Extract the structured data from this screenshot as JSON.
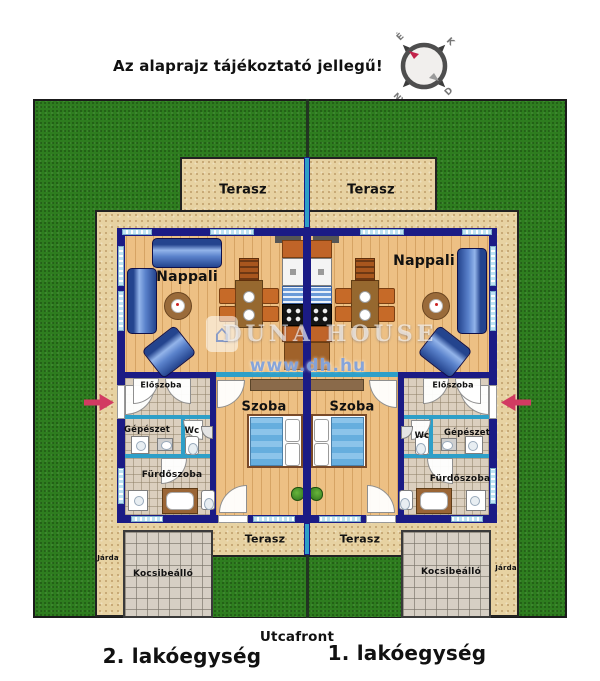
{
  "header": {
    "disclaimer": "Az alaprajz tájékoztató jellegű!"
  },
  "compass": {
    "n": "É",
    "e": "K",
    "s": "D",
    "w": "NY"
  },
  "rooms": {
    "terasz": "Terasz",
    "nappali": "Nappali",
    "szoba": "Szoba",
    "eloszoba": "Előszoba",
    "gepeszet": "Gépészet",
    "wc": "Wc",
    "furdoszoba": "Fürdőszoba",
    "kocsibeallo": "Kocsibeálló",
    "jarda": "Járda"
  },
  "footer": {
    "street": "Utcafront",
    "unit_left": "2. lakóegység",
    "unit_right": "1. lakóegység"
  },
  "watermark": {
    "brand": "DUNA HOUSE",
    "url": "www.dh.hu"
  },
  "colors": {
    "grass": "#2e7d1f",
    "paving_tan": "#e7d2a2",
    "outer_wall": "#1b1b85",
    "interior_wall": "#2e9fc8",
    "wood_floor": "#edc084",
    "entry_arrow": "#d23b62"
  }
}
